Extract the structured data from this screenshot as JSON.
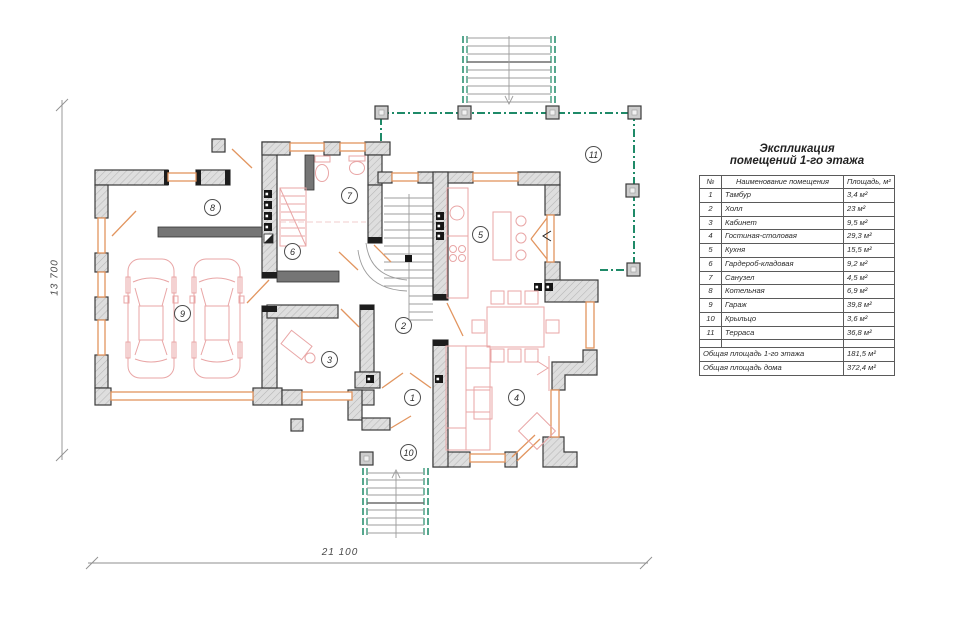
{
  "legend": {
    "title_line1": "Экспликация",
    "title_line2": "помещений 1-го этажа",
    "headers": {
      "num": "№",
      "name": "Наименование помещения",
      "area": "Площадь, м²"
    },
    "rows": [
      {
        "num": "1",
        "name": "Тамбур",
        "area": "3,4 м²"
      },
      {
        "num": "2",
        "name": "Холл",
        "area": "23 м²"
      },
      {
        "num": "3",
        "name": "Кабинет",
        "area": "9,5 м²"
      },
      {
        "num": "4",
        "name": "Гостиная-столовая",
        "area": "29,3 м²"
      },
      {
        "num": "5",
        "name": "Кухня",
        "area": "15,5 м²"
      },
      {
        "num": "6",
        "name": "Гардероб-кладовая",
        "area": "9,2 м²"
      },
      {
        "num": "7",
        "name": "Санузел",
        "area": "4,5 м²"
      },
      {
        "num": "8",
        "name": "Котельная",
        "area": "6,9 м²"
      },
      {
        "num": "9",
        "name": "Гараж",
        "area": "39,8 м²"
      },
      {
        "num": "10",
        "name": "Крыльцо",
        "area": "3,6 м²"
      },
      {
        "num": "11",
        "name": "Терраса",
        "area": "36,8 м²"
      }
    ],
    "totals": [
      {
        "label": "Общая площадь 1-го этажа",
        "area": "181,5 м²"
      },
      {
        "label": "Общая площадь дома",
        "area": "372,4 м²"
      }
    ]
  },
  "plan": {
    "dim_vertical": "13 700",
    "dim_horizontal": "21 100",
    "markers": [
      {
        "num": "1"
      },
      {
        "num": "2"
      },
      {
        "num": "3"
      },
      {
        "num": "4"
      },
      {
        "num": "5"
      },
      {
        "num": "6"
      },
      {
        "num": "7"
      },
      {
        "num": "8"
      },
      {
        "num": "9"
      },
      {
        "num": "10"
      },
      {
        "num": "11"
      }
    ],
    "colors": {
      "wall_stroke": "#3b3b3b",
      "window": "#e2955f",
      "terrace": "#1f8a68",
      "furniture": "#e9a6a6",
      "steps": "#9c9c9c",
      "dim": "#8f8f8f"
    }
  }
}
